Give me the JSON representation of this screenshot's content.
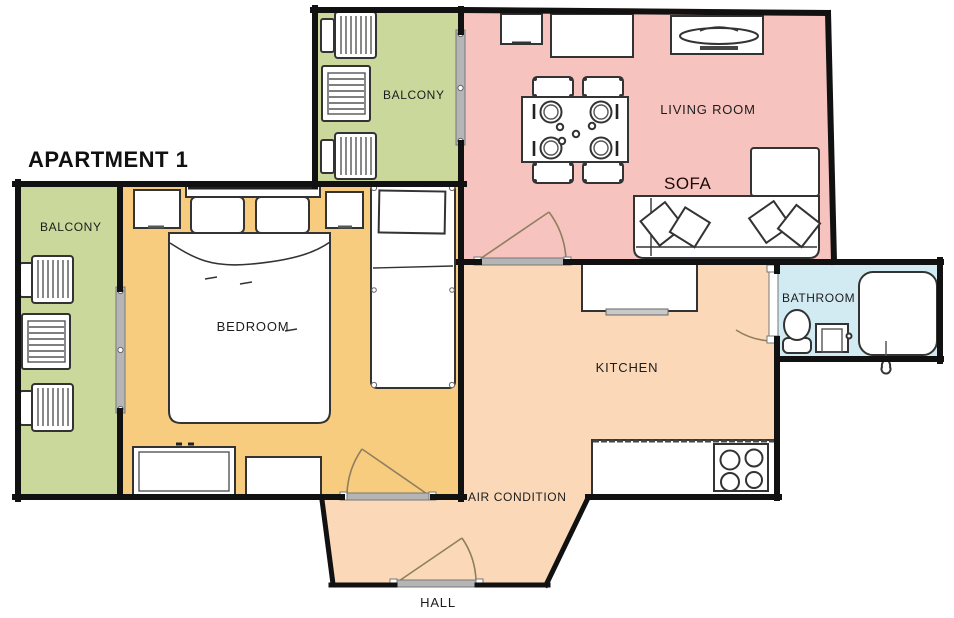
{
  "title": "APARTMENT 1",
  "rooms": {
    "balcony_left": {
      "label": "BALCONY"
    },
    "balcony_top": {
      "label": "BALCONY"
    },
    "bedroom": {
      "label": "BEDROOM"
    },
    "living_room": {
      "label": "LIVING ROOM"
    },
    "kitchen": {
      "label": "KITCHEN"
    },
    "bathroom": {
      "label": "BATHROOM"
    },
    "hall": {
      "label": "HALL"
    }
  },
  "annotations": {
    "sofa": "SOFA",
    "air_condition": "AIR CONDITION"
  },
  "colors": {
    "balcony": "#cad89b",
    "bedroom": "#f7cc7e",
    "living_room": "#f7c3bf",
    "kitchen": "#fbd9b8",
    "hall": "#fbd9b8",
    "bathroom": "#d2ebf2",
    "wall": "#111111",
    "furniture_fill": "#ffffff",
    "furniture_stroke": "#333333",
    "door_arc": "#8f7f5f",
    "door_slider": "#b5b5b5",
    "background": "#ffffff"
  }
}
